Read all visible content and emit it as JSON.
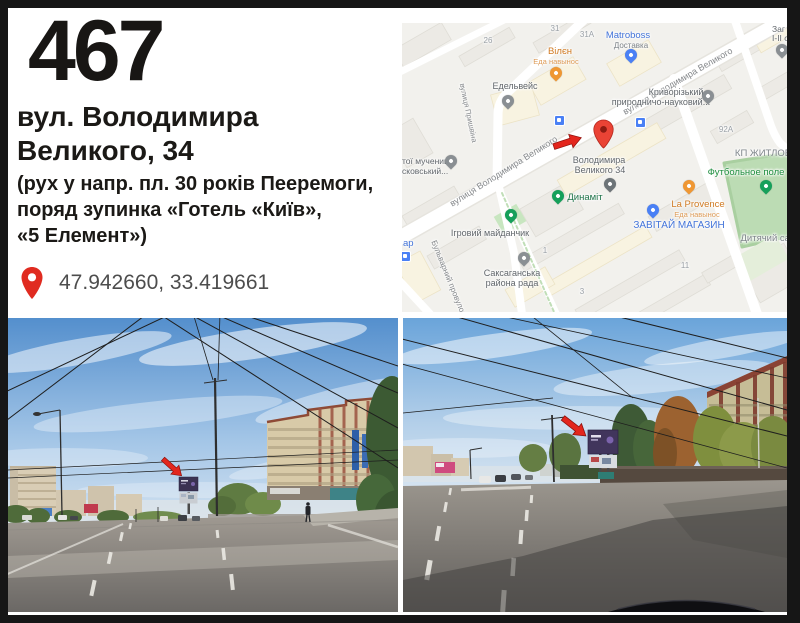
{
  "card": {
    "board_number": "467",
    "address_line1": "вул. Володимира",
    "address_line2": "Великого, 34",
    "note_line1": "(рух у напр. пл. 30 років Пееремоги,",
    "note_line2": "поряд зупинка «Готель «Київ»,",
    "note_line3": "«5 Елемент»)",
    "coordinates": "47.942660, 33.419661"
  },
  "map": {
    "streets": {
      "volodymyra_velykoho_upper": "вулиця Володимира Великого",
      "volodymyra_velykoho_lower": "вулиця Володимира Великого",
      "pryshvina": "вулиця Пришвіна",
      "bulvarnyi": "Бульварний провулок"
    },
    "pois": {
      "matroboss": {
        "name": "Matroboss",
        "sub": "Доставка"
      },
      "vilen": {
        "name": "Вілєн",
        "sub": "Еда навынос"
      },
      "edelveis": {
        "name": "Едельвейс"
      },
      "kryvorizkyi": {
        "name": "Криворізький",
        "sub": "природничо-науковий..."
      },
      "church": {
        "name": "тої мучениці",
        "sub": "сковський..."
      },
      "zah": {
        "name": "Заг",
        "sub": "І-ІІ с"
      },
      "target": {
        "name": "Володимира",
        "sub": "Великого 34"
      },
      "dynamit": {
        "name": "Динаміт"
      },
      "ihrovyi": {
        "name": "Ігровий майданчик"
      },
      "saksahanska": {
        "name": "Саксаганська",
        "sub": "района рада"
      },
      "zavitai": {
        "name": "ЗАВІТАЙ МАГАЗИН"
      },
      "la_provence": {
        "name": "La Provence",
        "sub": "Еда навынос"
      },
      "football": {
        "name": "Футбольное поле"
      },
      "kindergarten": {
        "name": "Дитячий сад"
      },
      "kp_zhytlov": {
        "name": "КП ЖИТЛОВ"
      },
      "ar": {
        "name": "ар"
      }
    },
    "building_numbers": [
      "26",
      "31",
      "31А",
      "92А",
      "11",
      "1",
      "3"
    ]
  },
  "colors": {
    "frame": "#161616",
    "accent_arrow_red": "#e3261d",
    "map_pin_red": "#ea4335",
    "poi_blue": "#4273d9",
    "poi_orange": "#d07a22",
    "poi_green": "#1e8e3e",
    "map_bg": "#f2f1ed",
    "field_green": "#bcdcb4"
  }
}
